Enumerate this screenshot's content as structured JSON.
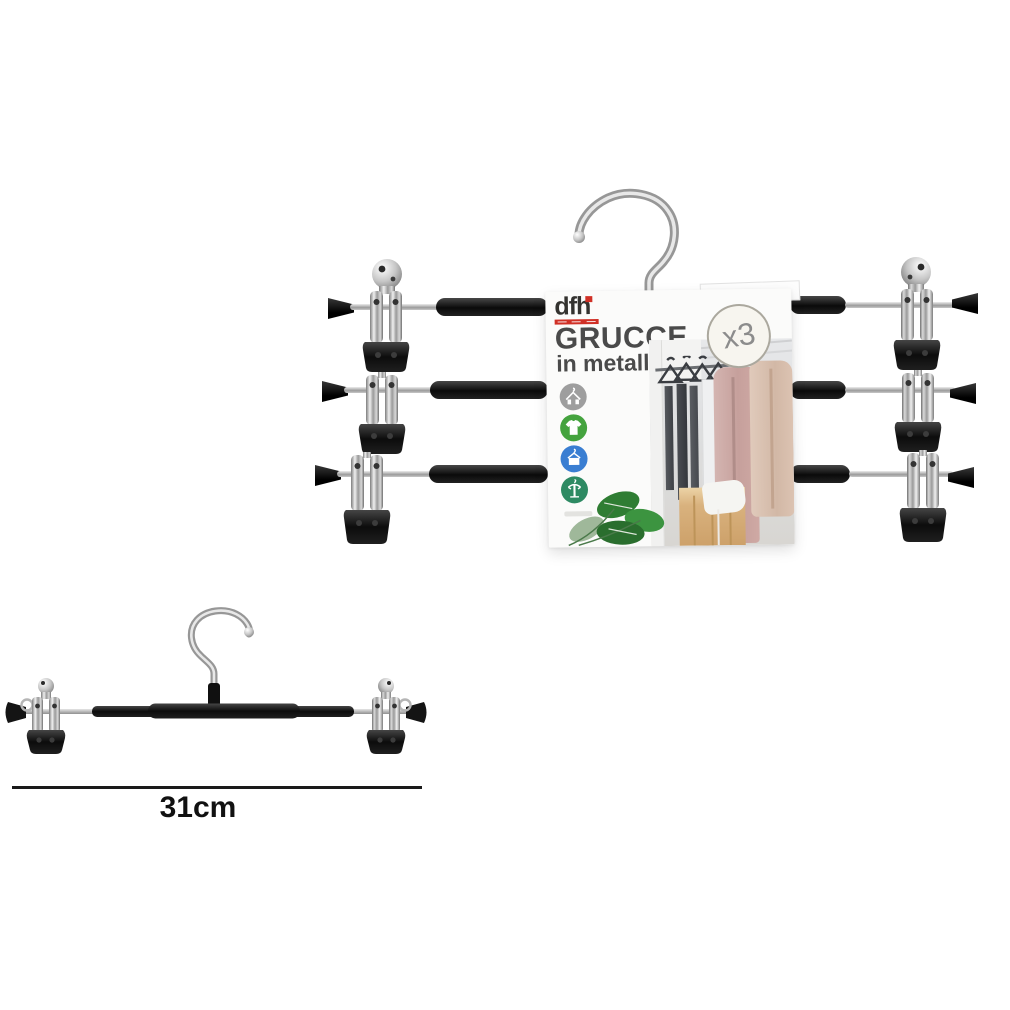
{
  "page": {
    "background": "#ffffff"
  },
  "product_card": {
    "brand": "dfh",
    "title": "GRUCCE",
    "subtitle": "in metallo",
    "badge": "x3",
    "brand_accent_color": "#d03026",
    "feature_icons": [
      {
        "name": "hanger-with-clips-icon",
        "circle_color": "#9e9e9e"
      },
      {
        "name": "tshirt-icon",
        "circle_color": "#44a33e"
      },
      {
        "name": "hanger-garment-icon",
        "circle_color": "#3a7ed2"
      },
      {
        "name": "hanger-stand-icon",
        "circle_color": "#2e8a63"
      }
    ]
  },
  "dimension_annotation": {
    "label": "31cm"
  },
  "materials": {
    "chrome": "#b9b9b9",
    "black_coating": "#141414"
  }
}
